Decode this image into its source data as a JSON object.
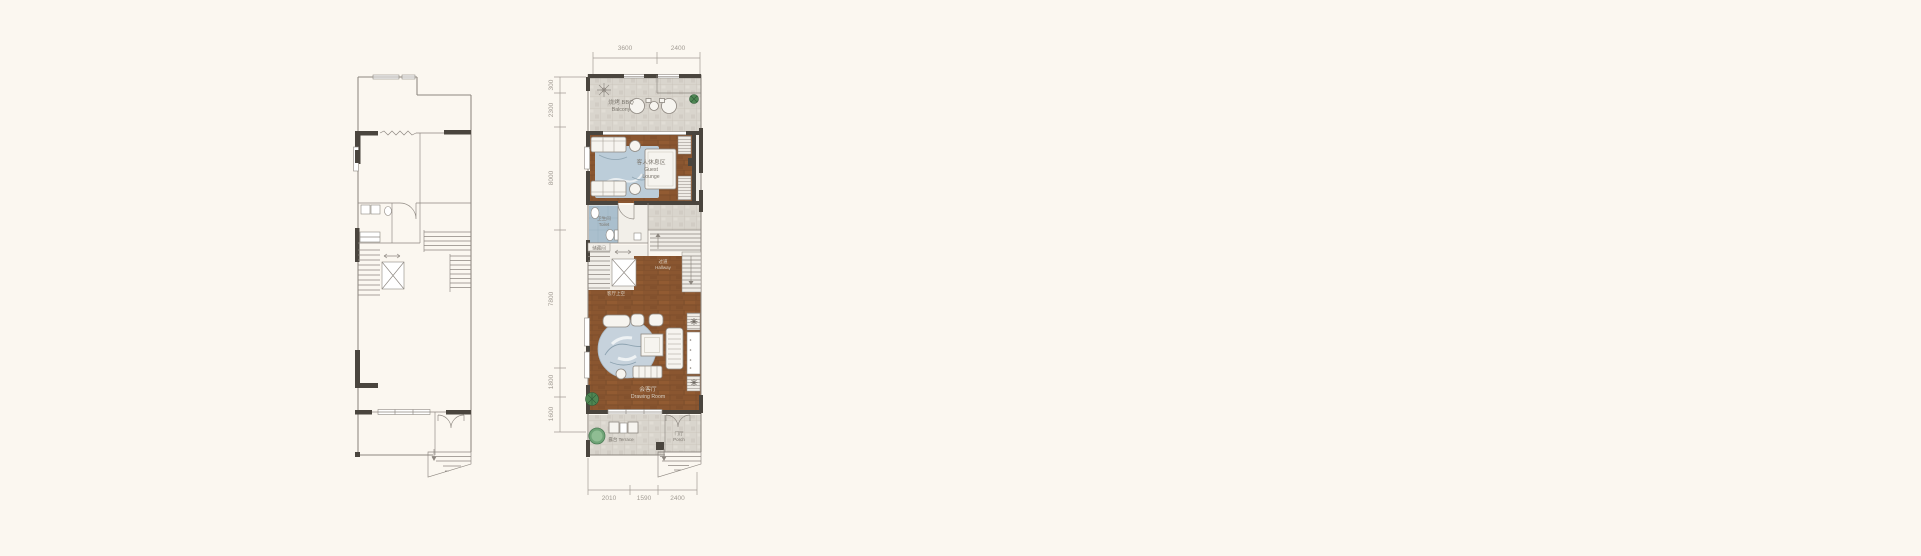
{
  "canvas": {
    "background": "#fbf7f0"
  },
  "colors": {
    "bg": "#fbf7f0",
    "wood": "#8a5630",
    "stone": "#d9d5cd",
    "rug": "#bccdd9",
    "plant": "#4e8653",
    "tub": "#6fa477",
    "wall": "#4a453e",
    "line": "#8d8780",
    "dim": "#a29c94",
    "label_dark": "#7c776f",
    "label_light": "#d8d0c3"
  },
  "furnished_plan": {
    "dimensions": {
      "top": [
        "3600",
        "2400"
      ],
      "left": [
        "300",
        "2300",
        "8000",
        "7800",
        "1800",
        "1600"
      ],
      "bottom": [
        "2010",
        "1590",
        "2400"
      ]
    },
    "rooms": {
      "bbq_balcony": {
        "zh": "烧烤 BBQ",
        "en": "Balcony"
      },
      "guest_lounge": {
        "zh": "客人休息区",
        "en_line1": "Guest",
        "en_line2": "Lounge"
      },
      "toilet": {
        "zh": "卫生间",
        "en": "Toilet"
      },
      "storage": {
        "zh": "储藏间"
      },
      "hallway": {
        "zh": "过道",
        "en": "Hallway"
      },
      "void_above_living": {
        "zh": "客厅上空"
      },
      "drawing_room": {
        "zh": "会客厅",
        "en": "Drawing Room"
      },
      "terrace": {
        "zh": "露台 Terrace"
      },
      "porch": {
        "zh": "门厅",
        "en": "Porch"
      }
    }
  }
}
